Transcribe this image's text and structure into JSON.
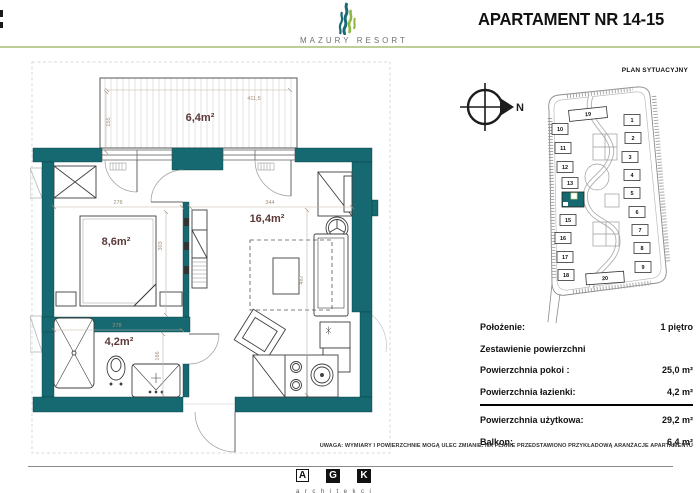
{
  "header": {
    "brand": "MAZURY RESORT",
    "title": "APARTAMENT NR 14-15"
  },
  "colors": {
    "wall_teal": "#166970",
    "accent_green": "#bccf97",
    "room_label": "#5d3939"
  },
  "floorplan": {
    "rooms": [
      {
        "name": "balcony",
        "area_label": "6,4m²",
        "x": 170,
        "y": 61
      },
      {
        "name": "bedroom",
        "area_label": "8,6m²",
        "x": 86,
        "y": 185
      },
      {
        "name": "living-room",
        "area_label": "16,4m²",
        "x": 237,
        "y": 162
      },
      {
        "name": "bathroom",
        "area_label": "4,2m²",
        "x": 89,
        "y": 285
      }
    ],
    "dimensions": [
      {
        "text": "411,5",
        "x": 224,
        "y": 40,
        "rot": 0
      },
      {
        "text": "155",
        "x": 80,
        "y": 62,
        "rot": -90
      },
      {
        "text": "278",
        "x": 88,
        "y": 144,
        "rot": 0
      },
      {
        "text": "344",
        "x": 240,
        "y": 144,
        "rot": 0
      },
      {
        "text": "303",
        "x": 132,
        "y": 186,
        "rot": -90
      },
      {
        "text": "487",
        "x": 273,
        "y": 220,
        "rot": -90
      },
      {
        "text": "278",
        "x": 87,
        "y": 267,
        "rot": 0
      },
      {
        "text": "166",
        "x": 129,
        "y": 296,
        "rot": -90
      }
    ]
  },
  "siteplan": {
    "title": "PLAN SYTUACYJNY",
    "compass_label": "N",
    "buildings": [
      {
        "label": "19",
        "x": 55,
        "y": 32,
        "wide": true,
        "tilt": -6
      },
      {
        "label": "10",
        "x": 27,
        "y": 47
      },
      {
        "label": "11",
        "x": 30,
        "y": 66
      },
      {
        "label": "12",
        "x": 32,
        "y": 85
      },
      {
        "label": "13",
        "x": 37,
        "y": 101
      },
      {
        "label": "",
        "x": 40,
        "y": 118,
        "highlighted": true
      },
      {
        "label": "15",
        "x": 35,
        "y": 138
      },
      {
        "label": "16",
        "x": 30,
        "y": 156
      },
      {
        "label": "17",
        "x": 32,
        "y": 175
      },
      {
        "label": "18",
        "x": 33,
        "y": 193
      },
      {
        "label": "20",
        "x": 72,
        "y": 196,
        "wide": true,
        "tilt": -4
      },
      {
        "label": "1",
        "x": 99,
        "y": 38
      },
      {
        "label": "2",
        "x": 100,
        "y": 56
      },
      {
        "label": "3",
        "x": 97,
        "y": 75
      },
      {
        "label": "4",
        "x": 99,
        "y": 93
      },
      {
        "label": "5",
        "x": 99,
        "y": 111
      },
      {
        "label": "6",
        "x": 104,
        "y": 130
      },
      {
        "label": "7",
        "x": 107,
        "y": 148
      },
      {
        "label": "8",
        "x": 109,
        "y": 166
      },
      {
        "label": "9",
        "x": 110,
        "y": 185
      }
    ]
  },
  "details": {
    "rows": [
      {
        "label": "Położenie:",
        "value": "1 piętro"
      },
      {
        "label": "Zestawienie powierzchni",
        "value": ""
      },
      {
        "label": "Powierzchnia pokoi :",
        "value": "25,0 m²"
      },
      {
        "label": "Powierzchnia łazienki:",
        "value": "4,2 m²"
      },
      {
        "label": "Powierzchnia użytkowa:",
        "value": "29,2 m²"
      },
      {
        "label": "Balkon:",
        "value": "6,4 m²"
      }
    ]
  },
  "disclaimer": "UWAGA: WYMIARY I POWIERZCHNIE MOGĄ ULEC ZMIANIE. NA PLANIE PRZEDSTAWIONO PRZYKŁADOWĄ ARANŻACJE APARTAMENTU",
  "footer_logo": {
    "letters": [
      "A",
      "G",
      "K"
    ],
    "caption": "architekci"
  }
}
